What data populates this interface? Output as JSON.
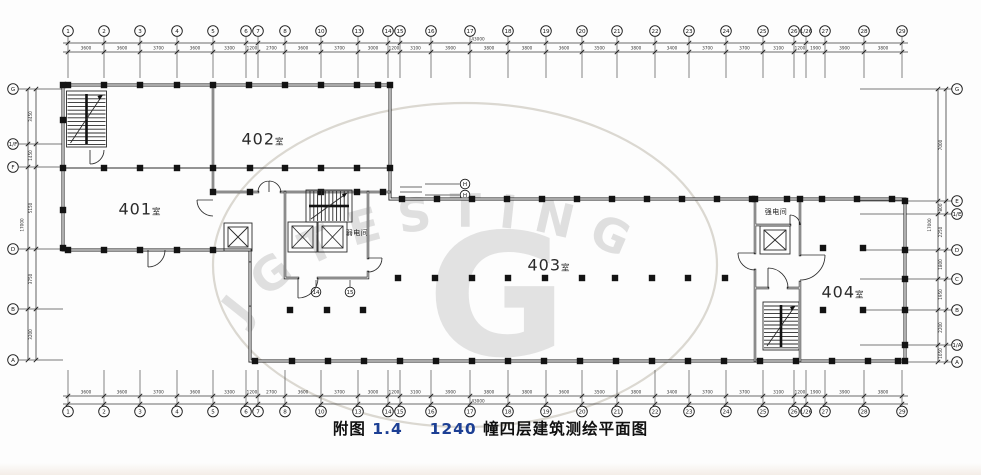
{
  "colors": {
    "line": "#1a1a1a",
    "accent_blue": "#1c3f94",
    "watermark": "#c9c9c9"
  },
  "caption": {
    "figure_label": "附图",
    "figure_no": "1.4",
    "building_no": "1240",
    "title_suffix": "幢四层建筑测绘平面图"
  },
  "watermark": {
    "arc_text": "JGTESTING",
    "big_letter": "G"
  },
  "rooms": [
    {
      "name": "401",
      "suffix": "室",
      "x": 140,
      "y": 209
    },
    {
      "name": "402",
      "suffix": "室",
      "x": 263,
      "y": 139
    },
    {
      "name": "403",
      "suffix": "室",
      "x": 549,
      "y": 265
    },
    {
      "name": "404",
      "suffix": "室",
      "x": 843,
      "y": 292
    }
  ],
  "service_rooms": {
    "weak": {
      "label": "弱电间",
      "x": 357,
      "y": 233
    },
    "strong": {
      "label": "强电间",
      "x": 776,
      "y": 212
    }
  },
  "grid": {
    "top": {
      "bubbles": [
        {
          "x": 68,
          "label": "1"
        },
        {
          "x": 104,
          "label": "2"
        },
        {
          "x": 140,
          "label": "3"
        },
        {
          "x": 177,
          "label": "4"
        },
        {
          "x": 213,
          "label": "5"
        },
        {
          "x": 246,
          "label": "6"
        },
        {
          "x": 258,
          "label": "7"
        },
        {
          "x": 285,
          "label": "8"
        },
        {
          "x": 321,
          "label": "10"
        },
        {
          "x": 358,
          "label": "13"
        },
        {
          "x": 388,
          "label": "14"
        },
        {
          "x": 400,
          "label": "15"
        },
        {
          "x": 431,
          "label": "16"
        },
        {
          "x": 470,
          "label": "17"
        },
        {
          "x": 508,
          "label": "18"
        },
        {
          "x": 546,
          "label": "19"
        },
        {
          "x": 582,
          "label": "20"
        },
        {
          "x": 617,
          "label": "21"
        },
        {
          "x": 655,
          "label": "22"
        },
        {
          "x": 689,
          "label": "23"
        },
        {
          "x": 726,
          "label": "24"
        },
        {
          "x": 763,
          "label": "25"
        },
        {
          "x": 794,
          "label": "26"
        },
        {
          "x": 806,
          "label": "1/26"
        },
        {
          "x": 825,
          "label": "27"
        },
        {
          "x": 864,
          "label": "28"
        },
        {
          "x": 902,
          "label": "29"
        }
      ],
      "dims": [
        "3600",
        "3600",
        "3700",
        "3600",
        "3300",
        "1200",
        "2700",
        "3600",
        "3700",
        "3000",
        "1200",
        "3100",
        "3900",
        "3800",
        "3800",
        "3600",
        "3500",
        "3800",
        "3400",
        "3700",
        "3700",
        "3100",
        "1200",
        "1900",
        "3900",
        "3800"
      ],
      "overall": "43000"
    },
    "bottom": {
      "bubbles": [
        {
          "x": 68,
          "label": "1"
        },
        {
          "x": 104,
          "label": "2"
        },
        {
          "x": 140,
          "label": "3"
        },
        {
          "x": 177,
          "label": "4"
        },
        {
          "x": 213,
          "label": "5"
        },
        {
          "x": 246,
          "label": "6"
        },
        {
          "x": 258,
          "label": "7"
        },
        {
          "x": 285,
          "label": "8"
        },
        {
          "x": 321,
          "label": "10"
        },
        {
          "x": 358,
          "label": "13"
        },
        {
          "x": 388,
          "label": "14"
        },
        {
          "x": 400,
          "label": "15"
        },
        {
          "x": 431,
          "label": "16"
        },
        {
          "x": 470,
          "label": "17"
        },
        {
          "x": 508,
          "label": "18"
        },
        {
          "x": 546,
          "label": "19"
        },
        {
          "x": 582,
          "label": "20"
        },
        {
          "x": 617,
          "label": "21"
        },
        {
          "x": 655,
          "label": "22"
        },
        {
          "x": 689,
          "label": "23"
        },
        {
          "x": 726,
          "label": "24"
        },
        {
          "x": 763,
          "label": "25"
        },
        {
          "x": 794,
          "label": "26"
        },
        {
          "x": 806,
          "label": "1/26"
        },
        {
          "x": 825,
          "label": "27"
        },
        {
          "x": 864,
          "label": "28"
        },
        {
          "x": 902,
          "label": "29"
        }
      ],
      "dims": [
        "3600",
        "3600",
        "3700",
        "3600",
        "3300",
        "1200",
        "2700",
        "3600",
        "3700",
        "3000",
        "1200",
        "3100",
        "3900",
        "3800",
        "3800",
        "3600",
        "3500",
        "3800",
        "3400",
        "3700",
        "3700",
        "3100",
        "1200",
        "1900",
        "3900",
        "3800"
      ],
      "overall": "43000"
    },
    "left": {
      "bubbles": [
        {
          "y": 89,
          "label": "G"
        },
        {
          "y": 144,
          "label": "1/F"
        },
        {
          "y": 167,
          "label": "F"
        },
        {
          "y": 249,
          "label": "D"
        },
        {
          "y": 309,
          "label": "B"
        },
        {
          "y": 360,
          "label": "A"
        }
      ],
      "dims": [
        "3450",
        "1450",
        "5150",
        "3750",
        "3200"
      ],
      "overall": "17000"
    },
    "right": {
      "bubbles": [
        {
          "y": 89,
          "label": "G"
        },
        {
          "y": 201,
          "label": "E"
        },
        {
          "y": 214,
          "label": "1/E"
        },
        {
          "y": 250,
          "label": "D"
        },
        {
          "y": 279,
          "label": "C"
        },
        {
          "y": 310,
          "label": "B"
        },
        {
          "y": 345,
          "label": "1/A"
        },
        {
          "y": 362,
          "label": "A"
        }
      ],
      "dims": [
        "7000",
        "800",
        "2250",
        "1800",
        "1950",
        "2200",
        "1050"
      ],
      "overall": "17000"
    },
    "extra_bubbles": [
      {
        "x": 465,
        "y": 184,
        "label": "H",
        "leader": "h"
      },
      {
        "x": 465,
        "y": 195,
        "label": "H",
        "leader": "h"
      },
      {
        "x": 316,
        "y": 292,
        "label": "14",
        "leader": "v"
      },
      {
        "x": 350,
        "y": 292,
        "label": "15",
        "leader": "v"
      }
    ]
  }
}
